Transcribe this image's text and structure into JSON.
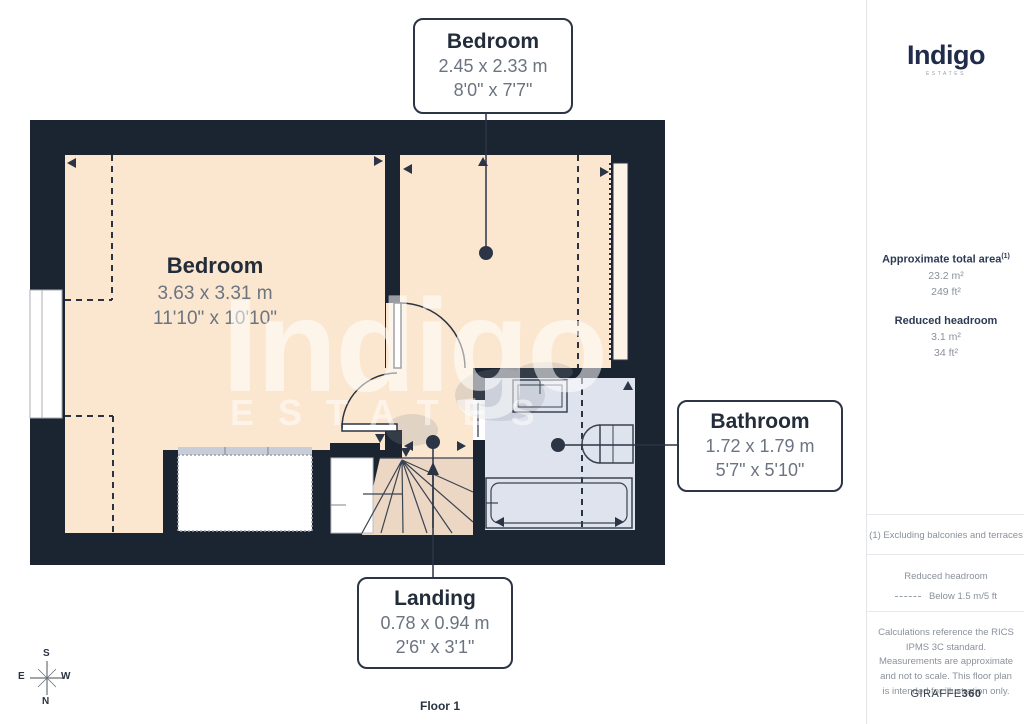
{
  "floor_plan": {
    "floor_label": "Floor 1",
    "watermark": {
      "brand": "Indigo",
      "sub": "ESTATES"
    },
    "rooms": [
      {
        "id": "bedroom-top",
        "name": "Bedroom",
        "metric": "2.45 x 2.33 m",
        "imperial": "8'0\" x 7'7\""
      },
      {
        "id": "bedroom-main",
        "name": "Bedroom",
        "metric": "3.63 x 3.31 m",
        "imperial": "11'10\" x 10'10\""
      },
      {
        "id": "bathroom",
        "name": "Bathroom",
        "metric": "1.72 x 1.79 m",
        "imperial": "5'7\" x 5'10\""
      },
      {
        "id": "landing",
        "name": "Landing",
        "metric": "0.78 x 0.94 m",
        "imperial": "2'6\" x 3'1\""
      }
    ],
    "compass": {
      "n": "N",
      "s": "S",
      "e": "E",
      "w": "W"
    }
  },
  "sidebar": {
    "brand": {
      "name": "Indigo",
      "tagline": "ESTATES"
    },
    "area": {
      "title": "Approximate total area",
      "title_superscript": "(1)",
      "metric": "23.2 m²",
      "imperial": "249 ft²"
    },
    "reduced_headroom": {
      "title": "Reduced headroom",
      "metric": "3.1 m²",
      "imperial": "34 ft²"
    },
    "footnote": "(1) Excluding balconies and terraces",
    "legend": {
      "title": "Reduced headroom",
      "label": "Below 1.5 m/5 ft"
    },
    "disclaimer": "Calculations reference the RICS IPMS 3C standard. Measurements are approximate and not to scale. This floor plan is intended for illustration only.",
    "provider": {
      "name": "GIRAFFE",
      "suffix": "360"
    }
  },
  "colors": {
    "wall": "#1b2531",
    "room_fill": "#fbe7d0",
    "stairs_fill": "#ecd7c5",
    "bathroom_fill": "#dee3ee",
    "label_border": "#2b3545",
    "dim_text": "#6b7480",
    "sidebar_text": "#8a919c",
    "brand_navy": "#202c49"
  }
}
